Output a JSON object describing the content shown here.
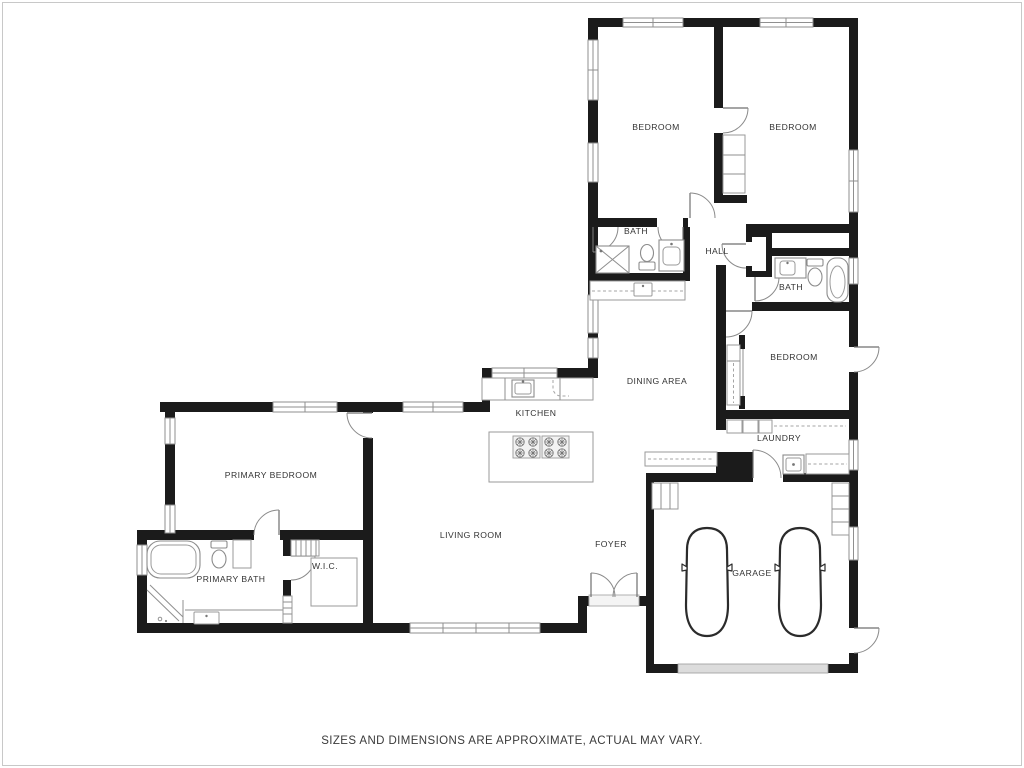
{
  "plan": {
    "disclaimer": "SIZES AND DIMENSIONS ARE APPROXIMATE, ACTUAL MAY VARY.",
    "rooms": {
      "bedroom1": "BEDROOM",
      "bedroom2": "BEDROOM",
      "bedroom3": "BEDROOM",
      "bath1": "BATH",
      "bath2": "BATH",
      "hall": "HALL",
      "dining": "DINING AREA",
      "kitchen": "KITCHEN",
      "laundry": "LAUNDRY",
      "primary_bedroom": "PRIMARY BEDROOM",
      "primary_bath": "PRIMARY BATH",
      "wic": "W.I.C.",
      "living": "LIVING ROOM",
      "foyer": "FOYER",
      "garage": "GARAGE"
    },
    "colors": {
      "wall": "#1b1b1b",
      "fixture_line": "#8f8f8f",
      "text": "#333333",
      "frame": "#c8c8c8"
    }
  }
}
